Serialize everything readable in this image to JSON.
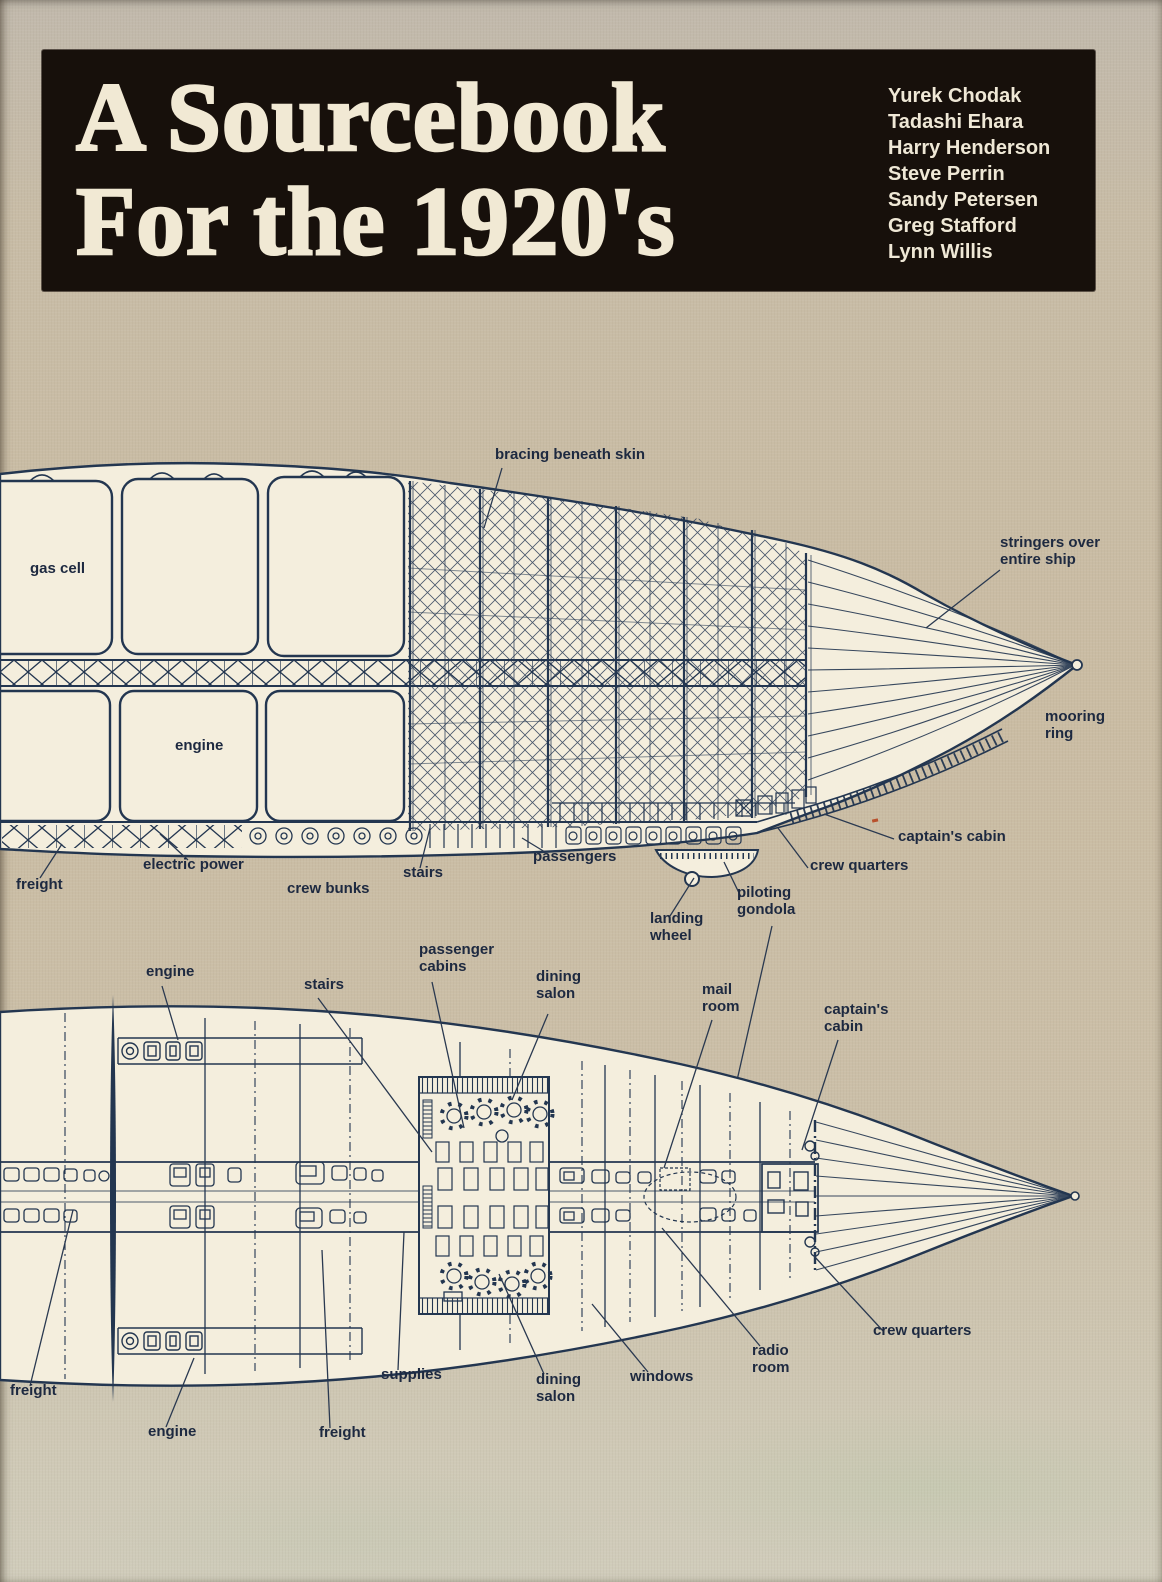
{
  "colors": {
    "page_background": "#c8bda8",
    "diagram_paper": "#f4eedd",
    "ink": "#233650",
    "title_background": "#17100b",
    "title_text": "#f1e9d4",
    "accent_speck": "#b8502c"
  },
  "header": {
    "title_line1": "A Sourcebook",
    "title_line2": "For the 1920's",
    "authors": [
      "Yurek Chodak",
      "Tadashi Ehara",
      "Harry Henderson",
      "Steve Perrin",
      "Sandy Petersen",
      "Greg Stafford",
      "Lynn Willis"
    ]
  },
  "side_view": {
    "description": "airship side cutaway diagram",
    "labels": {
      "bracing": "bracing beneath skin",
      "gas_cell": "gas cell",
      "engine": "engine",
      "stringers": "stringers over\nentire ship",
      "mooring_ring": "mooring\nring",
      "captains_cabin": "captain's cabin",
      "crew_quarters": "crew quarters",
      "passengers": "passengers",
      "stairs": "stairs",
      "electric_power": "electric power",
      "freight": "freight",
      "crew_bunks": "crew bunks",
      "piloting_gondola": "piloting\ngondola",
      "landing_wheel": "landing\nwheel"
    }
  },
  "plan_view": {
    "description": "airship deck plan diagram",
    "labels": {
      "engine_fore": "engine",
      "stairs": "stairs",
      "passenger_cabins": "passenger\ncabins",
      "dining_salon_upper": "dining\nsalon",
      "mail_room": "mail\nroom",
      "captains_cabin": "captain's\ncabin",
      "crew_quarters": "crew quarters",
      "radio_room": "radio\nroom",
      "windows": "windows",
      "dining_salon_lower": "dining\nsalon",
      "supplies": "supplies",
      "freight_mid": "freight",
      "engine_aft": "engine",
      "freight_aft": "freight"
    }
  }
}
